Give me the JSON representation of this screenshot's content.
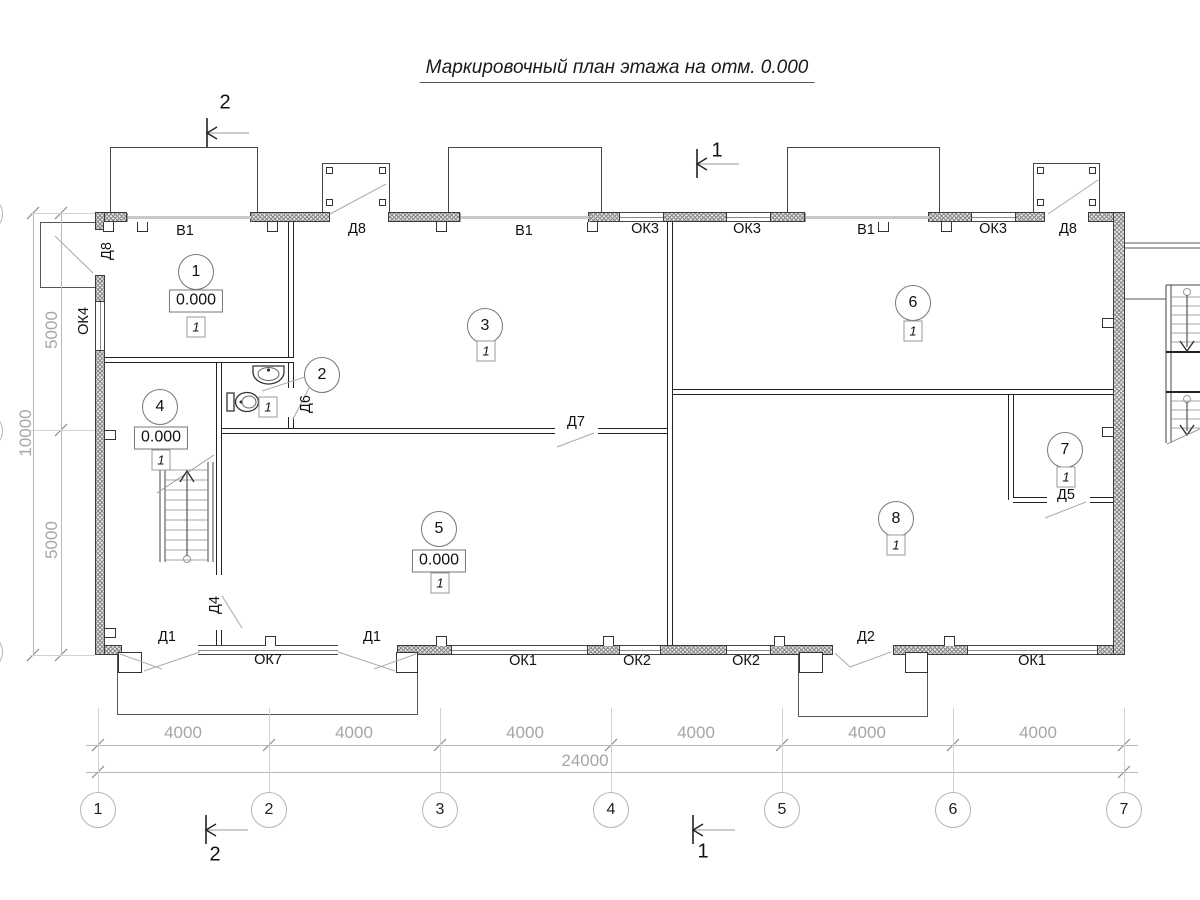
{
  "title": "Маркировочный план этажа на отм. 0.000",
  "rooms": {
    "r1": {
      "num": "1",
      "elev": "0.000",
      "type": "1"
    },
    "r2": {
      "num": "2",
      "type": "1"
    },
    "r3": {
      "num": "3",
      "type": "1"
    },
    "r4": {
      "num": "4",
      "elev": "0.000",
      "type": "1"
    },
    "r5": {
      "num": "5",
      "elev": "0.000",
      "type": "1"
    },
    "r6": {
      "num": "6",
      "type": "1"
    },
    "r7": {
      "num": "7",
      "type": "1"
    },
    "r8": {
      "num": "8",
      "type": "1"
    }
  },
  "openings": {
    "d8_left": "Д8",
    "v1_a": "В1",
    "d8_top_a": "Д8",
    "v1_b": "В1",
    "ok3_a": "ОК3",
    "ok3_b": "ОК3",
    "v1_c": "В1",
    "ok3_c": "ОК3",
    "d8_top_b": "Д8",
    "ok4": "ОК4",
    "d1_a": "Д1",
    "ok7": "ОК7",
    "d1_b": "Д1",
    "ok1_a": "ОК1",
    "ok2_a": "ОК2",
    "ok2_b": "ОК2",
    "d2": "Д2",
    "ok1_b": "ОК1",
    "d4": "Д4",
    "d6": "Д6",
    "d7": "Д7",
    "d5": "Д5"
  },
  "dims": {
    "h": [
      "4000",
      "4000",
      "4000",
      "4000",
      "4000",
      "4000"
    ],
    "total": "24000",
    "v_top": "5000",
    "v_total": "10000",
    "v_bottom": "5000"
  },
  "axes": [
    "1",
    "2",
    "3",
    "4",
    "5",
    "6",
    "7"
  ],
  "sections": {
    "top_left": "2",
    "top_mid": "1",
    "bottom_left": "2",
    "bottom_mid": "1"
  }
}
